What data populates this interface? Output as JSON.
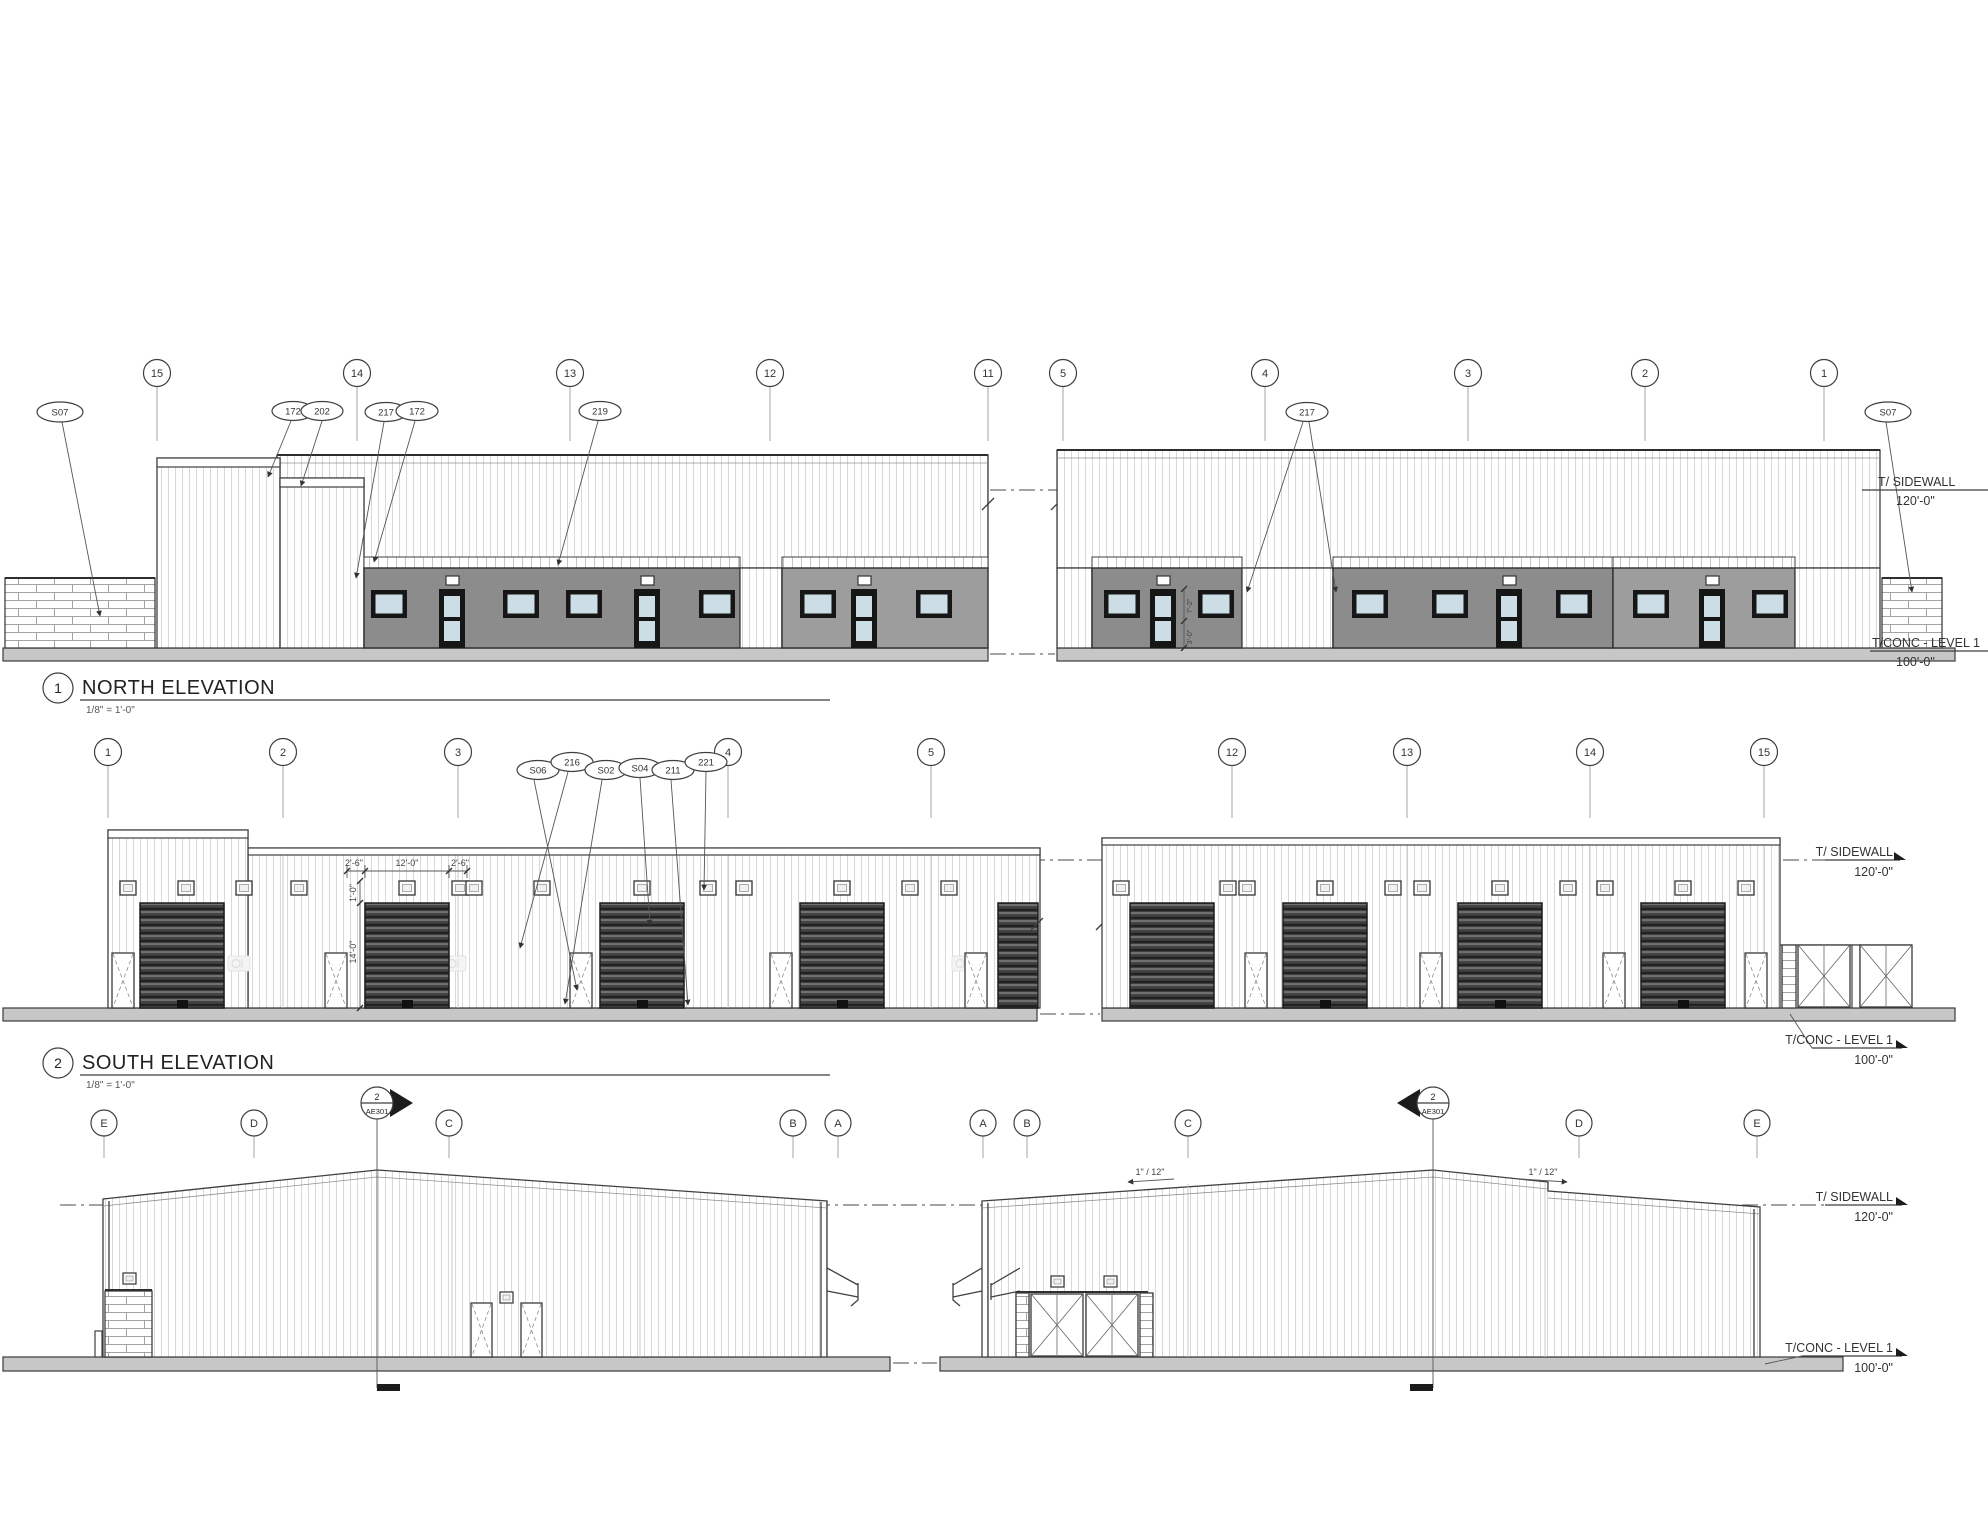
{
  "scale_label": "1/8\" = 1'-0\"",
  "levels": {
    "sidewall": "T/ SIDEWALL",
    "sidewall_elev": "120'-0\"",
    "conc": "T/CONC - LEVEL 1",
    "conc_elev": "100'-0\""
  },
  "north": {
    "number": "1",
    "title": "NORTH ELEVATION",
    "grids": [
      "15",
      "14",
      "13",
      "12",
      "11",
      "5",
      "4",
      "3",
      "2",
      "1"
    ],
    "keynotes": [
      "S07",
      "172",
      "202",
      "217",
      "172",
      "219",
      "217",
      "S07"
    ],
    "door_dims": [
      "7'-2\"",
      "3'-0\""
    ]
  },
  "south": {
    "number": "2",
    "title": "SOUTH ELEVATION",
    "grids": [
      "1",
      "2",
      "3",
      "4",
      "5",
      "12",
      "13",
      "14",
      "15"
    ],
    "keynotes": [
      "S06",
      "216",
      "S02",
      "S04",
      "211",
      "221"
    ],
    "dims_horizontal": [
      "2'-6\"",
      "12'-0\"",
      "2'-6\""
    ],
    "dims_vertical": [
      "1'-0\"",
      "14'-0\""
    ]
  },
  "ends": {
    "left_grids": [
      "E",
      "D",
      "C",
      "B",
      "A"
    ],
    "right_grids": [
      "A",
      "B",
      "C",
      "D",
      "E"
    ],
    "section_marker": {
      "number": "2",
      "sheet": "AE301"
    },
    "roof_slope": "1\" / 12\""
  }
}
